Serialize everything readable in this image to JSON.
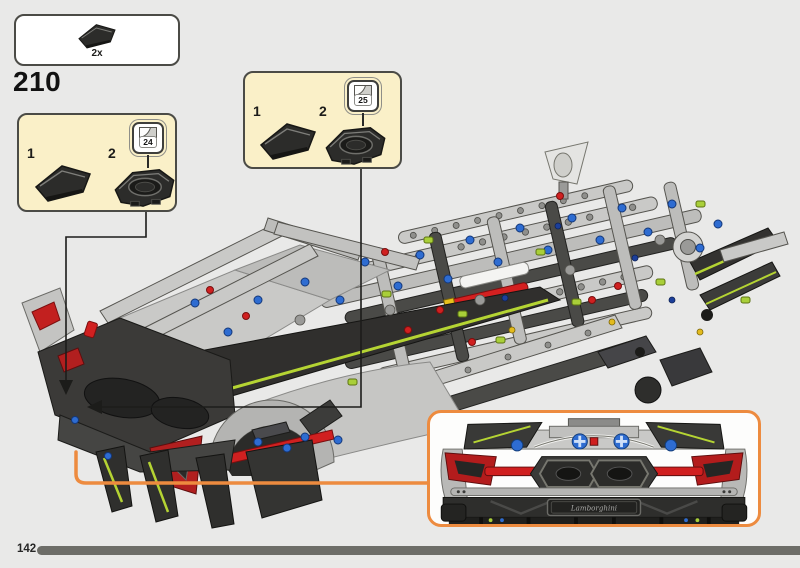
{
  "page": {
    "step_number": "210",
    "page_number": "142"
  },
  "parts_box": {
    "quantity": "2x",
    "piece": "black-wedge-panel"
  },
  "callout_left": {
    "item1": "1",
    "item2": "2",
    "sticker_number": "24",
    "sticker_icon": "sticker-peel-icon"
  },
  "callout_top": {
    "item1": "1",
    "item2": "2",
    "sticker_number": "25",
    "sticker_icon": "sticker-peel-icon"
  },
  "inset": {
    "brand_text": "Lamborghini"
  },
  "colors": {
    "background": "#e9e9e8",
    "callout_bg": "#faf0c8",
    "callout_border": "#4b4b46",
    "accent_orange": "#ed8b3f",
    "progress_bar": "#6d6d68",
    "lego_body_gray": "#c9c9c7",
    "lego_dark_gray": "#31302e",
    "lego_red": "#d02020",
    "lego_blue": "#2e6cd1",
    "lego_lime": "#b5d433"
  }
}
